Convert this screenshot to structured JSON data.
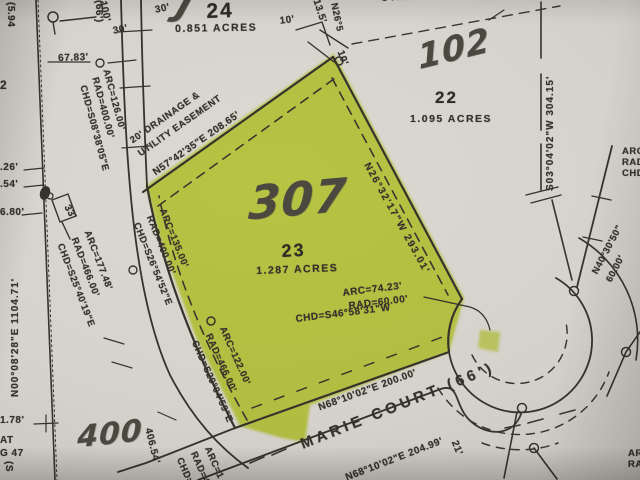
{
  "colors": {
    "highlight": "#c9e02c",
    "ink": "#36332c",
    "paper": "#d5d2cc",
    "handwriting": "#4b4840"
  },
  "lots": {
    "lot24": {
      "number": "24",
      "area": "0.851 ACRES"
    },
    "lot22": {
      "number": "22",
      "area": "1.095 ACRES",
      "handwritten_tag": "102"
    },
    "lot23": {
      "number": "23",
      "area": "1.287 ACRES",
      "handwritten_tag": "307",
      "cul_de_sac_curve": {
        "arc": "ARC=74.23'",
        "radius": "RAD=60.00'",
        "chord": "CHD=S46°58'31\"W"
      }
    }
  },
  "street": {
    "name": "MARIE COURT (66')",
    "frontage_bearing": "N68°10'02\"E 200.00'",
    "south_bearing": "N68°10'02\"E 204.99'"
  },
  "bearings": {
    "nw_easement_line1": "20' DRAINAGE &",
    "nw_easement_line2": "UTILITY EASEMENT",
    "nw": "N57°42'35\"E 208.65'",
    "ne": "N26°32'17\"W 293.01'",
    "east": "S03°04'02\"W 304.15'",
    "west_section": "N00°08'28\"E 1104.71'",
    "top_easement": "UTILITY EASEMENT",
    "cul_radial": "N40°30'50\"",
    "cul_radius": "60.00'"
  },
  "curves": {
    "c1": {
      "arc": "ARC=126.00'",
      "radius": "RAD=400.00'",
      "chord": "CHD=S08°38'05\"E"
    },
    "c2": {
      "arc": "ARC=135.00'",
      "radius": "RAD=400.00'",
      "chord": "CHD=S26°54'52\"E"
    },
    "c3": {
      "arc": "ARC=177.48'",
      "radius": "RAD=466.00'",
      "chord": "CHD=S25°40'19\"E"
    },
    "c4": {
      "arc": "ARC=122.00'",
      "radius": "RAD=466.00'",
      "chord": "CHD=S29°04'59\"E"
    },
    "c5": {
      "arc": "ARC=1",
      "radius": "RAD=4",
      "chord": "CHD=S"
    },
    "c6": {
      "arc": "ARC=",
      "radius": "RAD=",
      "chord": "CHD="
    },
    "c7": {
      "arc": "ARC",
      "radius": "RAD"
    }
  },
  "dimensions": {
    "d5_94": "(5.94",
    "street_width_left": "(66')",
    "lot_frag": "2",
    "d67": "67.83'",
    "d30a": "30'",
    "d30b": "30'",
    "d100": "100'",
    "d10a": "10'",
    "d10b": "10'",
    "d13": "13.5'",
    "n26_frag": "N26°5",
    "t26": ".26'",
    "t54": ".54'",
    "t680": "6.80'",
    "t178": "1.78'",
    "frag_at": "AT",
    "frag_g47": "G 47",
    "frag_s": "(S",
    "d406": "406.54'",
    "d33": "33'",
    "d21": "21'"
  },
  "handwriting": {
    "tag400": "400",
    "stroke": "J"
  }
}
